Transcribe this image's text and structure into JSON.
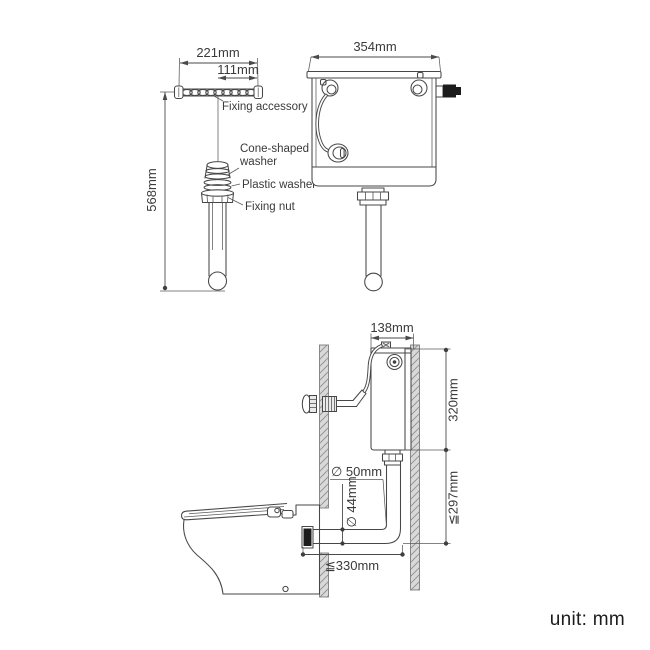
{
  "meta": {
    "unit_note": "unit: mm"
  },
  "colors": {
    "line": "#474747",
    "text": "#3a3a3a",
    "dark_fitting": "#1c1c1c",
    "wall_fill": "#d9d9d9",
    "hatch_line": "#8f8f8f",
    "background": "#ffffff"
  },
  "fixing_diagram": {
    "dim_width": "221mm",
    "dim_half_width": "111mm",
    "dim_height": "568mm",
    "labels": {
      "fixing_accessory": "Fixing accessory",
      "cone_washer_line1": "Cone-shaped",
      "cone_washer_line2": "washer",
      "plastic_washer": "Plastic washer",
      "fixing_nut": "Fixing nut"
    }
  },
  "cistern_front": {
    "dim_width": "354mm"
  },
  "installation": {
    "dim_width": "138mm",
    "dim_height": "320mm",
    "dim_outlet_drop": "≦297mm",
    "dim_pipe_outer": "∅ 50mm",
    "dim_pipe_inner": "∅ 44mm",
    "dim_offset": "≦330mm"
  }
}
